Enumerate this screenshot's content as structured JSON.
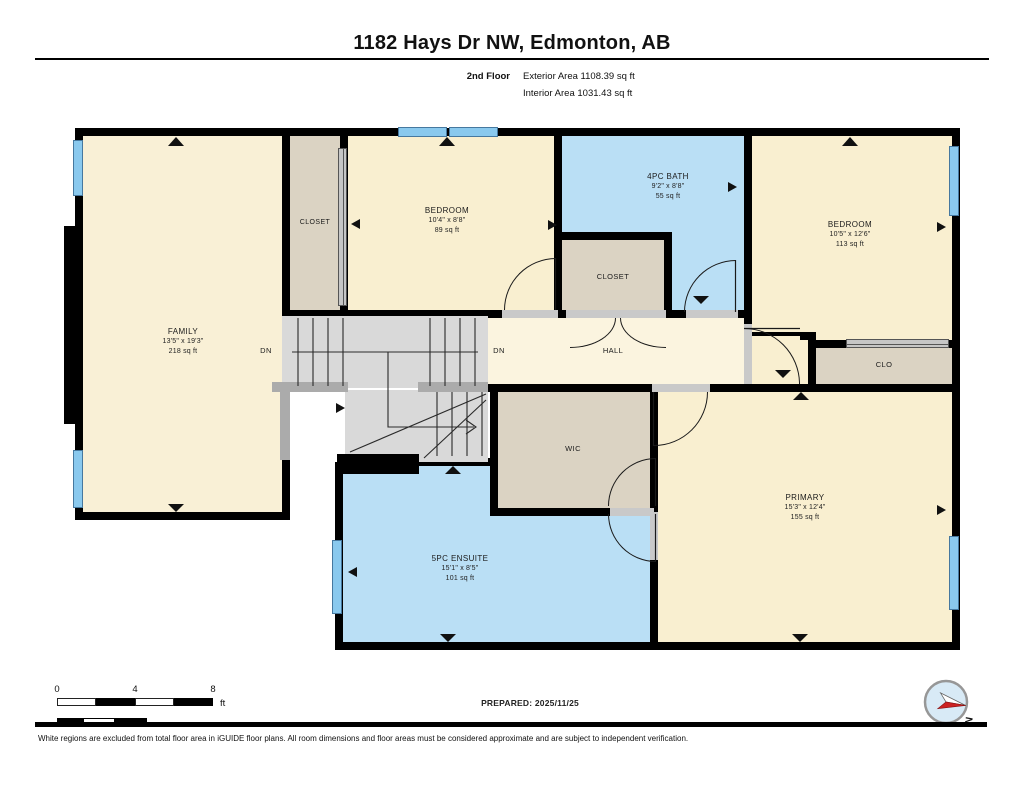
{
  "header": {
    "title": "1182 Hays Dr NW, Edmonton, AB",
    "floor_label": "2nd Floor",
    "exterior_area": "Exterior Area 1108.39 sq ft",
    "interior_area": "Interior Area 1031.43 sq ft"
  },
  "rooms": {
    "family": {
      "name": "FAMILY",
      "dims": "13'5\" x 19'3\"",
      "area": "218 sq ft"
    },
    "bedroom_mid": {
      "name": "BEDROOM",
      "dims": "10'4\" x 8'8\"",
      "area": "89 sq ft"
    },
    "bath": {
      "name": "4PC BATH",
      "dims": "9'2\" x 8'8\"",
      "area": "55 sq ft"
    },
    "bedroom_right": {
      "name": "BEDROOM",
      "dims": "10'5\" x 12'6\"",
      "area": "113 sq ft"
    },
    "primary": {
      "name": "PRIMARY",
      "dims": "15'3\" x 12'4\"",
      "area": "155 sq ft"
    },
    "ensuite": {
      "name": "5PC ENSUITE",
      "dims": "15'1\" x 8'5\"",
      "area": "101 sq ft"
    },
    "closet_top": {
      "name": "CLOSET"
    },
    "closet_mid": {
      "name": "CLOSET"
    },
    "clo": {
      "name": "CLO"
    },
    "wic": {
      "name": "WIC"
    },
    "hall": {
      "name": "HALL"
    }
  },
  "stairs": {
    "down_label_left": "DN",
    "down_label_right": "DN"
  },
  "scale_bar": {
    "tick_0": "0",
    "tick_4": "4",
    "tick_8": "8",
    "unit": "ft"
  },
  "footer": {
    "prepared": "PREPARED: 2025/11/25",
    "disclaimer": "White regions are excluded from total floor area in iGUIDE floor plans. All room dimensions and floor areas must be considered approximate and are subject to independent verification."
  },
  "compass": {
    "north_label": "N"
  },
  "colors": {
    "wall": "#000000",
    "room_fill": "#F9EFD0",
    "family_fill": "#F9F0D6",
    "hall_fill": "#FBF4DF",
    "wet_room_fill": "#BADFF5",
    "closet_fill": "#DBD3C3",
    "stairs_fill": "#D9D9D9",
    "window_fill": "#8AC9EE",
    "compass_needle": "#CC2222"
  }
}
